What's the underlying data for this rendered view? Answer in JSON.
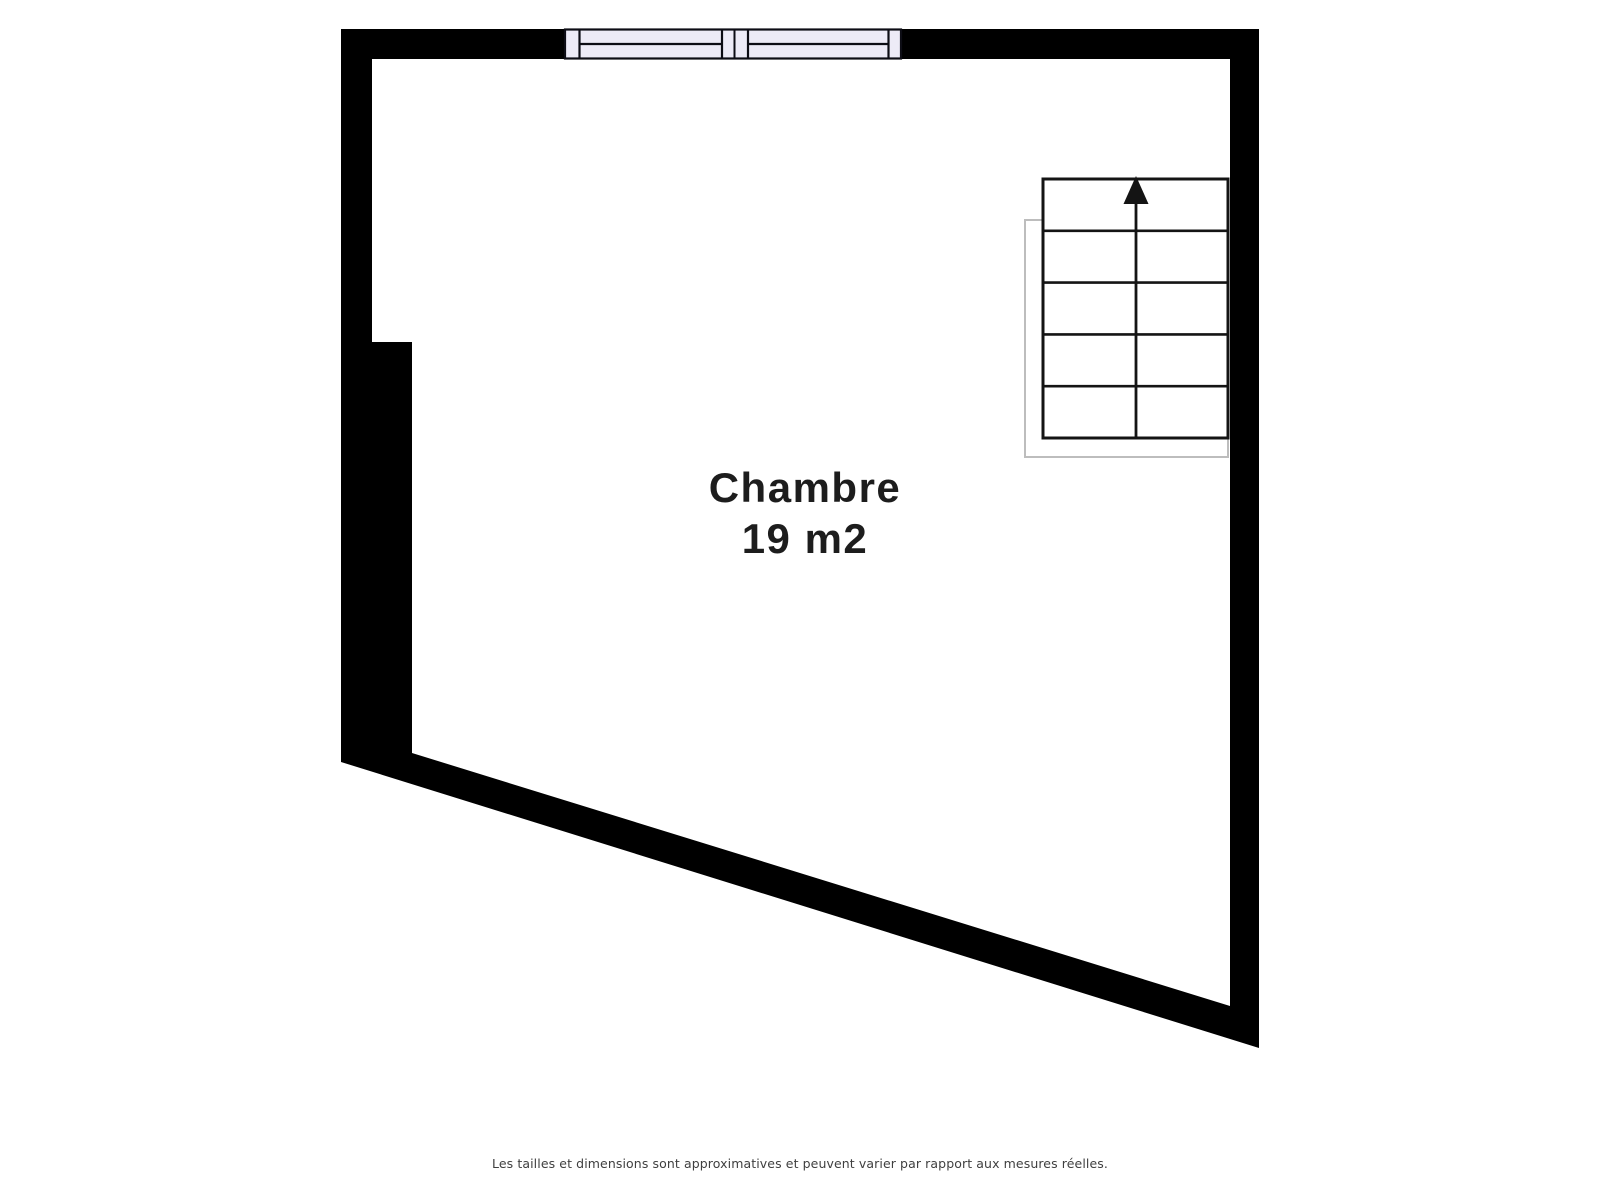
{
  "room": {
    "name": "Chambre",
    "area_label": "19 m2"
  },
  "footer": {
    "disclaimer": "Les tailles et dimensions sont approximatives et peuvent varier par rapport aux mesures réelles."
  },
  "icons": {
    "stairs_up_arrow": "triangle-up"
  },
  "colors": {
    "background": "#ffffff",
    "wall": "#000000",
    "room_fill": "#ffffff",
    "window_fill": "#edebf7",
    "window_frame": "#0d0d15",
    "stair_line": "#141414",
    "stair_fill": "#ffffff",
    "stair_outline": "#bdbdbd",
    "room_text": "#1d1d1d",
    "footer_text": "#3f3f3f"
  }
}
